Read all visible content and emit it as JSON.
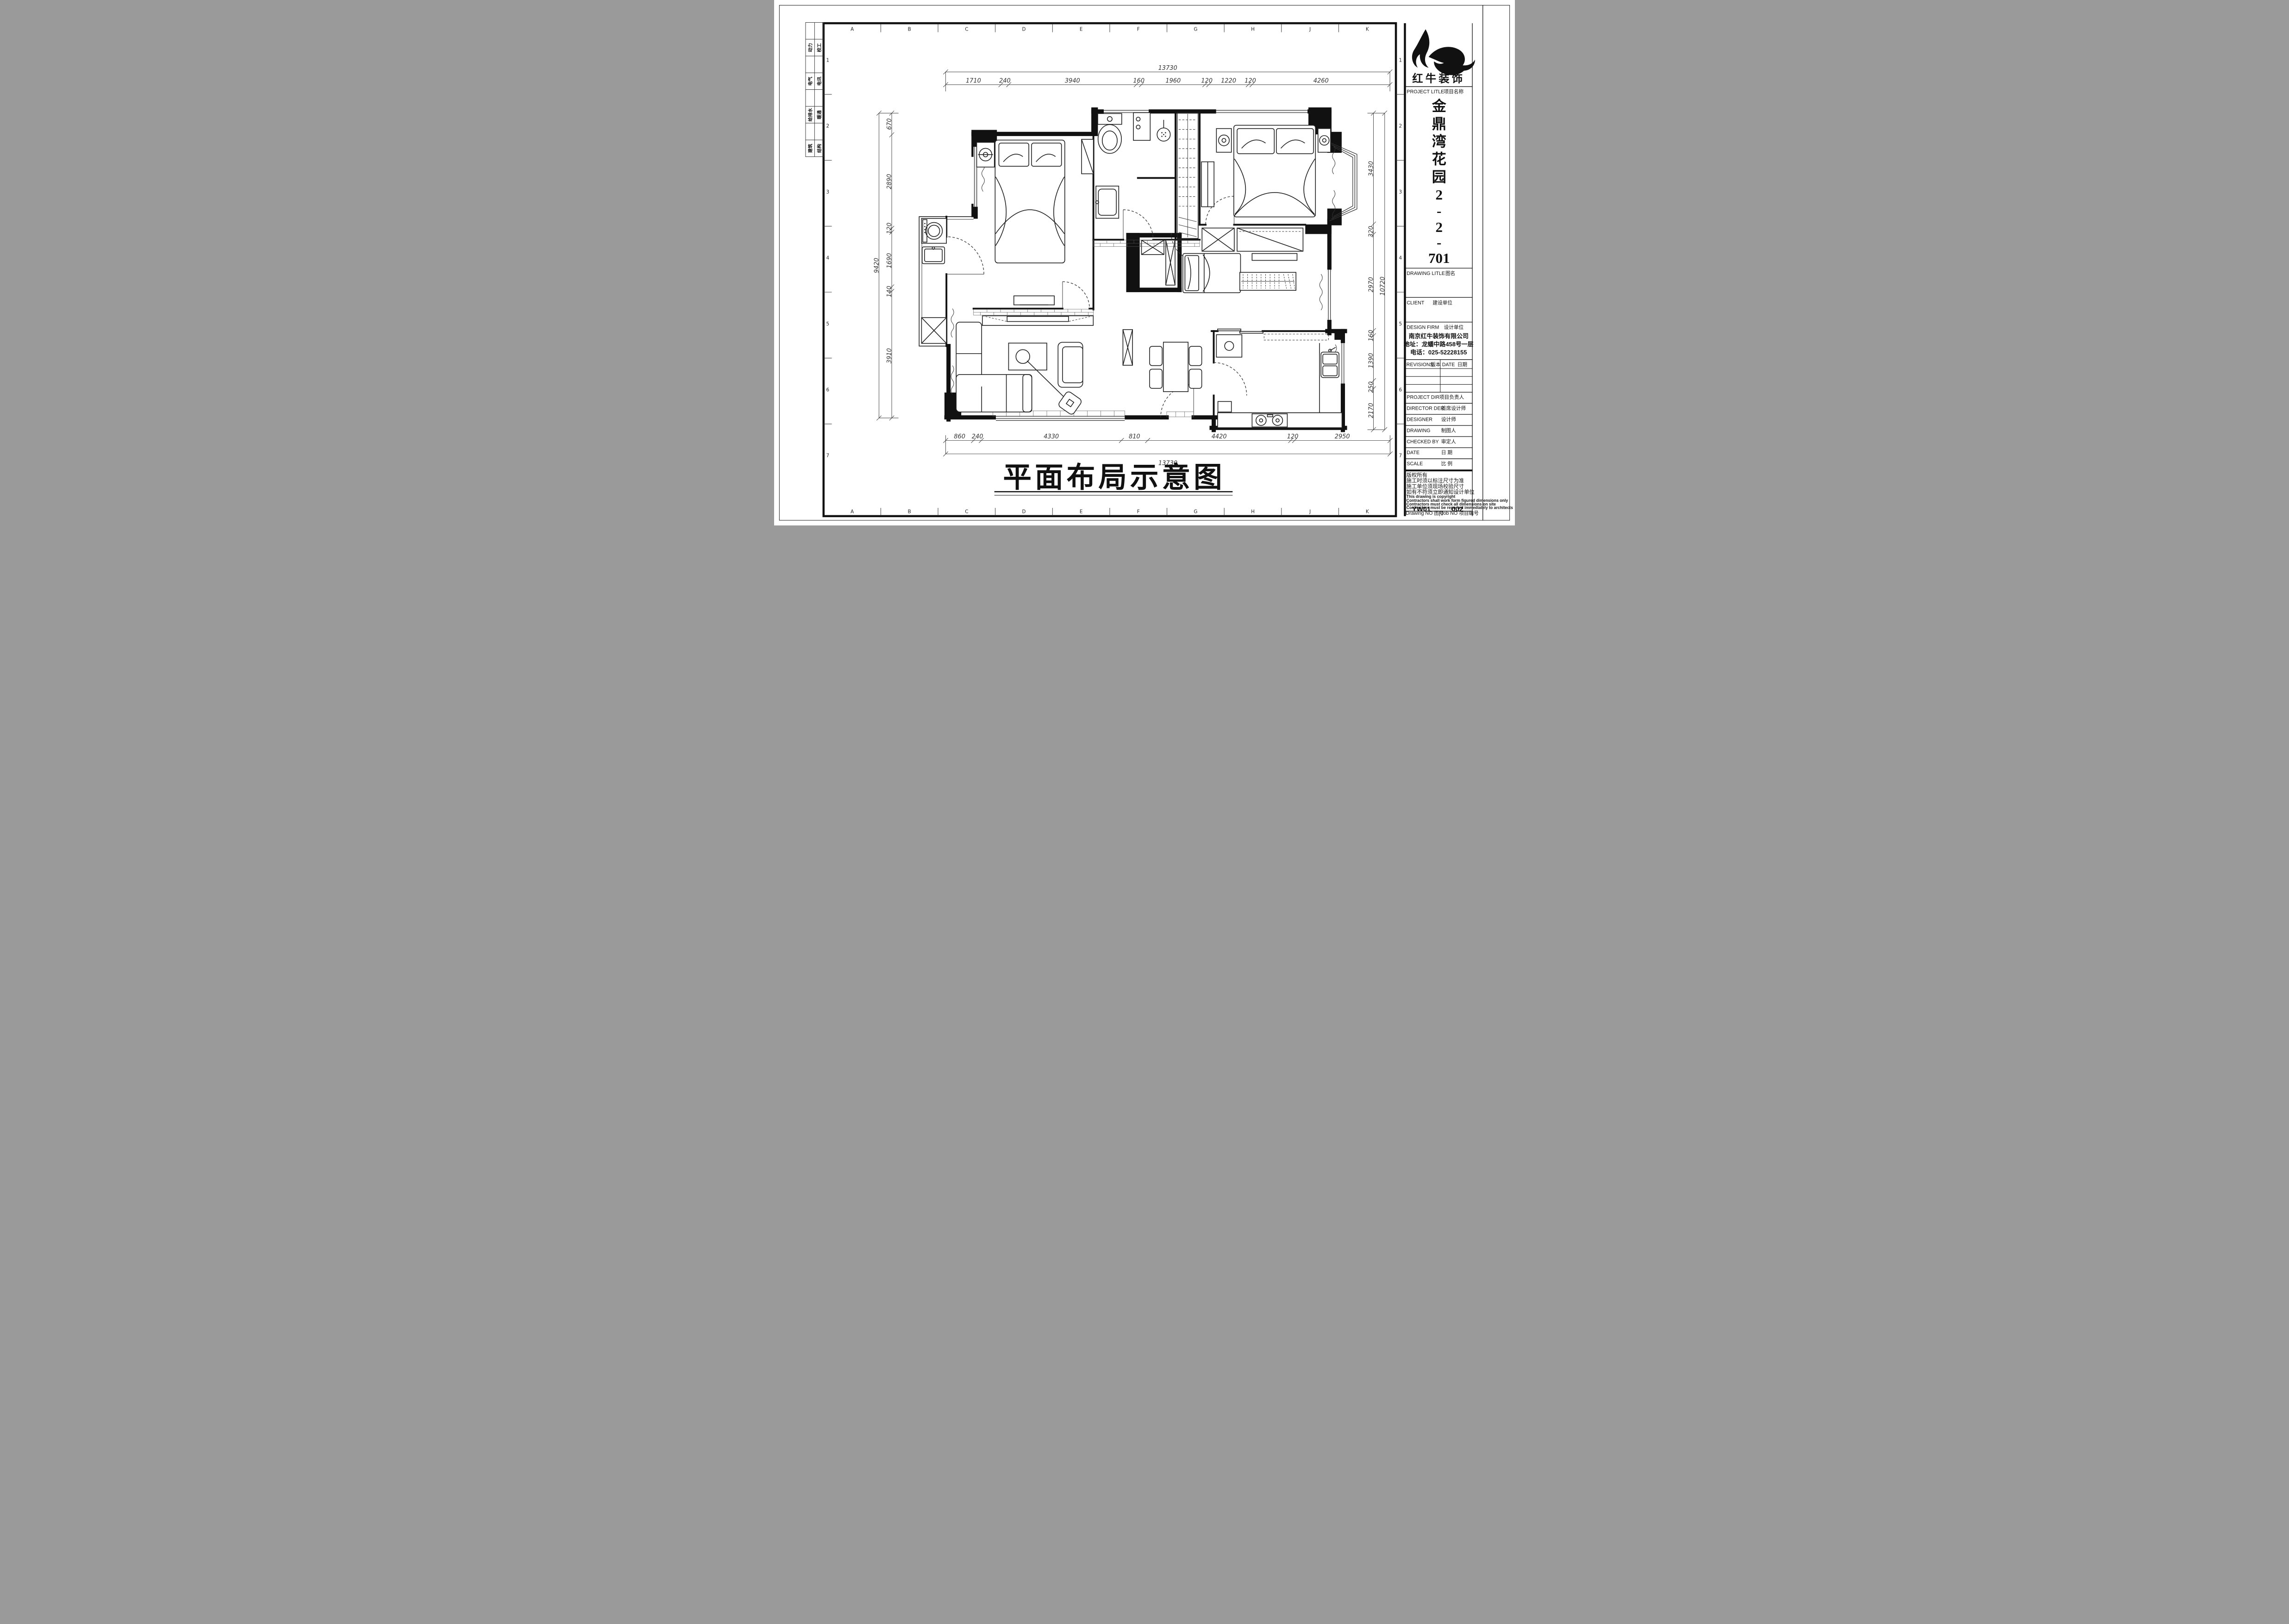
{
  "sheet": {
    "grid_letters": [
      "A",
      "B",
      "C",
      "D",
      "E",
      "F",
      "G",
      "H",
      "J",
      "K"
    ],
    "grid_numbers": [
      "1",
      "2",
      "3",
      "4",
      "5",
      "6",
      "7"
    ],
    "disciplines": [
      "动力",
      "校工",
      "电气",
      "电讯",
      "给排水",
      "暖通",
      "建筑",
      "结构"
    ]
  },
  "drawing": {
    "title": "平面布局示意图",
    "dims_top": [
      "1710",
      "240",
      "3940",
      "160",
      "1960",
      "120",
      "1220",
      "120",
      "4260"
    ],
    "dims_top_total": "13730",
    "dims_bottom": [
      "860",
      "240",
      "4330",
      "810",
      "4420",
      "120",
      "2950"
    ],
    "dims_bottom_total": "13730",
    "dims_left": [
      "670",
      "2890",
      "120",
      "1690",
      "140",
      "3910"
    ],
    "dims_left_total": "9420",
    "dims_right": [
      "3430",
      "320",
      "2970",
      "160",
      "1390",
      "250",
      "2170"
    ],
    "dims_right_total": "10720"
  },
  "title_block": {
    "brand": "红牛装饰",
    "project_label": "PROJECT LITLE",
    "project_label_zh": "项目名称",
    "name_chars": [
      "金",
      "鼎",
      "湾",
      "花",
      "园",
      "2",
      "-",
      "2",
      "-",
      "701"
    ],
    "drawing_label": "DRAWING LITLE",
    "drawing_label_zh": "图名",
    "client_label": "CLIENT",
    "client_label_zh": "建设单位",
    "firm_label": "DESIGN FIRM",
    "firm_label_zh": "设计单位",
    "firm_name": "南京红牛装饰有限公司",
    "firm_address": "地址：龙蟠中路458号一层",
    "firm_phone": "电话：025-52228155",
    "revisions_label": "REVISIONS",
    "revisions_label_zh": "版本",
    "date_col_label": "DATE",
    "date_col_label_zh": "日期",
    "project_dir_label": "PROJECT DIR",
    "project_dir_label_zh": "项目负责人",
    "director_label": "DIRECTOR DER",
    "director_label_zh": "首席设计师",
    "designer_label": "DESIGNER",
    "designer_label_zh": "设计师",
    "drawing_by_label": "DRAWING",
    "drawing_by_label_zh": "制图人",
    "checked_label": "CHECKED BY",
    "checked_label_zh": "审定人",
    "date_label": "DATE",
    "date_label_zh": "日  期",
    "scale_label": "SCALE",
    "scale_label_zh": "比  例",
    "notes": [
      "版权所有",
      "施工时须以标注尺寸为准",
      "施工单位须现场校验尺寸",
      "如有不符须立即通知设计单位",
      "This drawing is copyright",
      "Contractors shall work form figured dimensions only",
      "Contractors must check all dimensions on site",
      "Contractors must be reported immediately to architects"
    ],
    "drawing_no_label": "Drawing NO",
    "drawing_no_label_zh": "图号",
    "drawing_no": "YW01",
    "job_no_label": "Job NO",
    "job_no_label_zh": "项目编号",
    "job_no": "002"
  }
}
